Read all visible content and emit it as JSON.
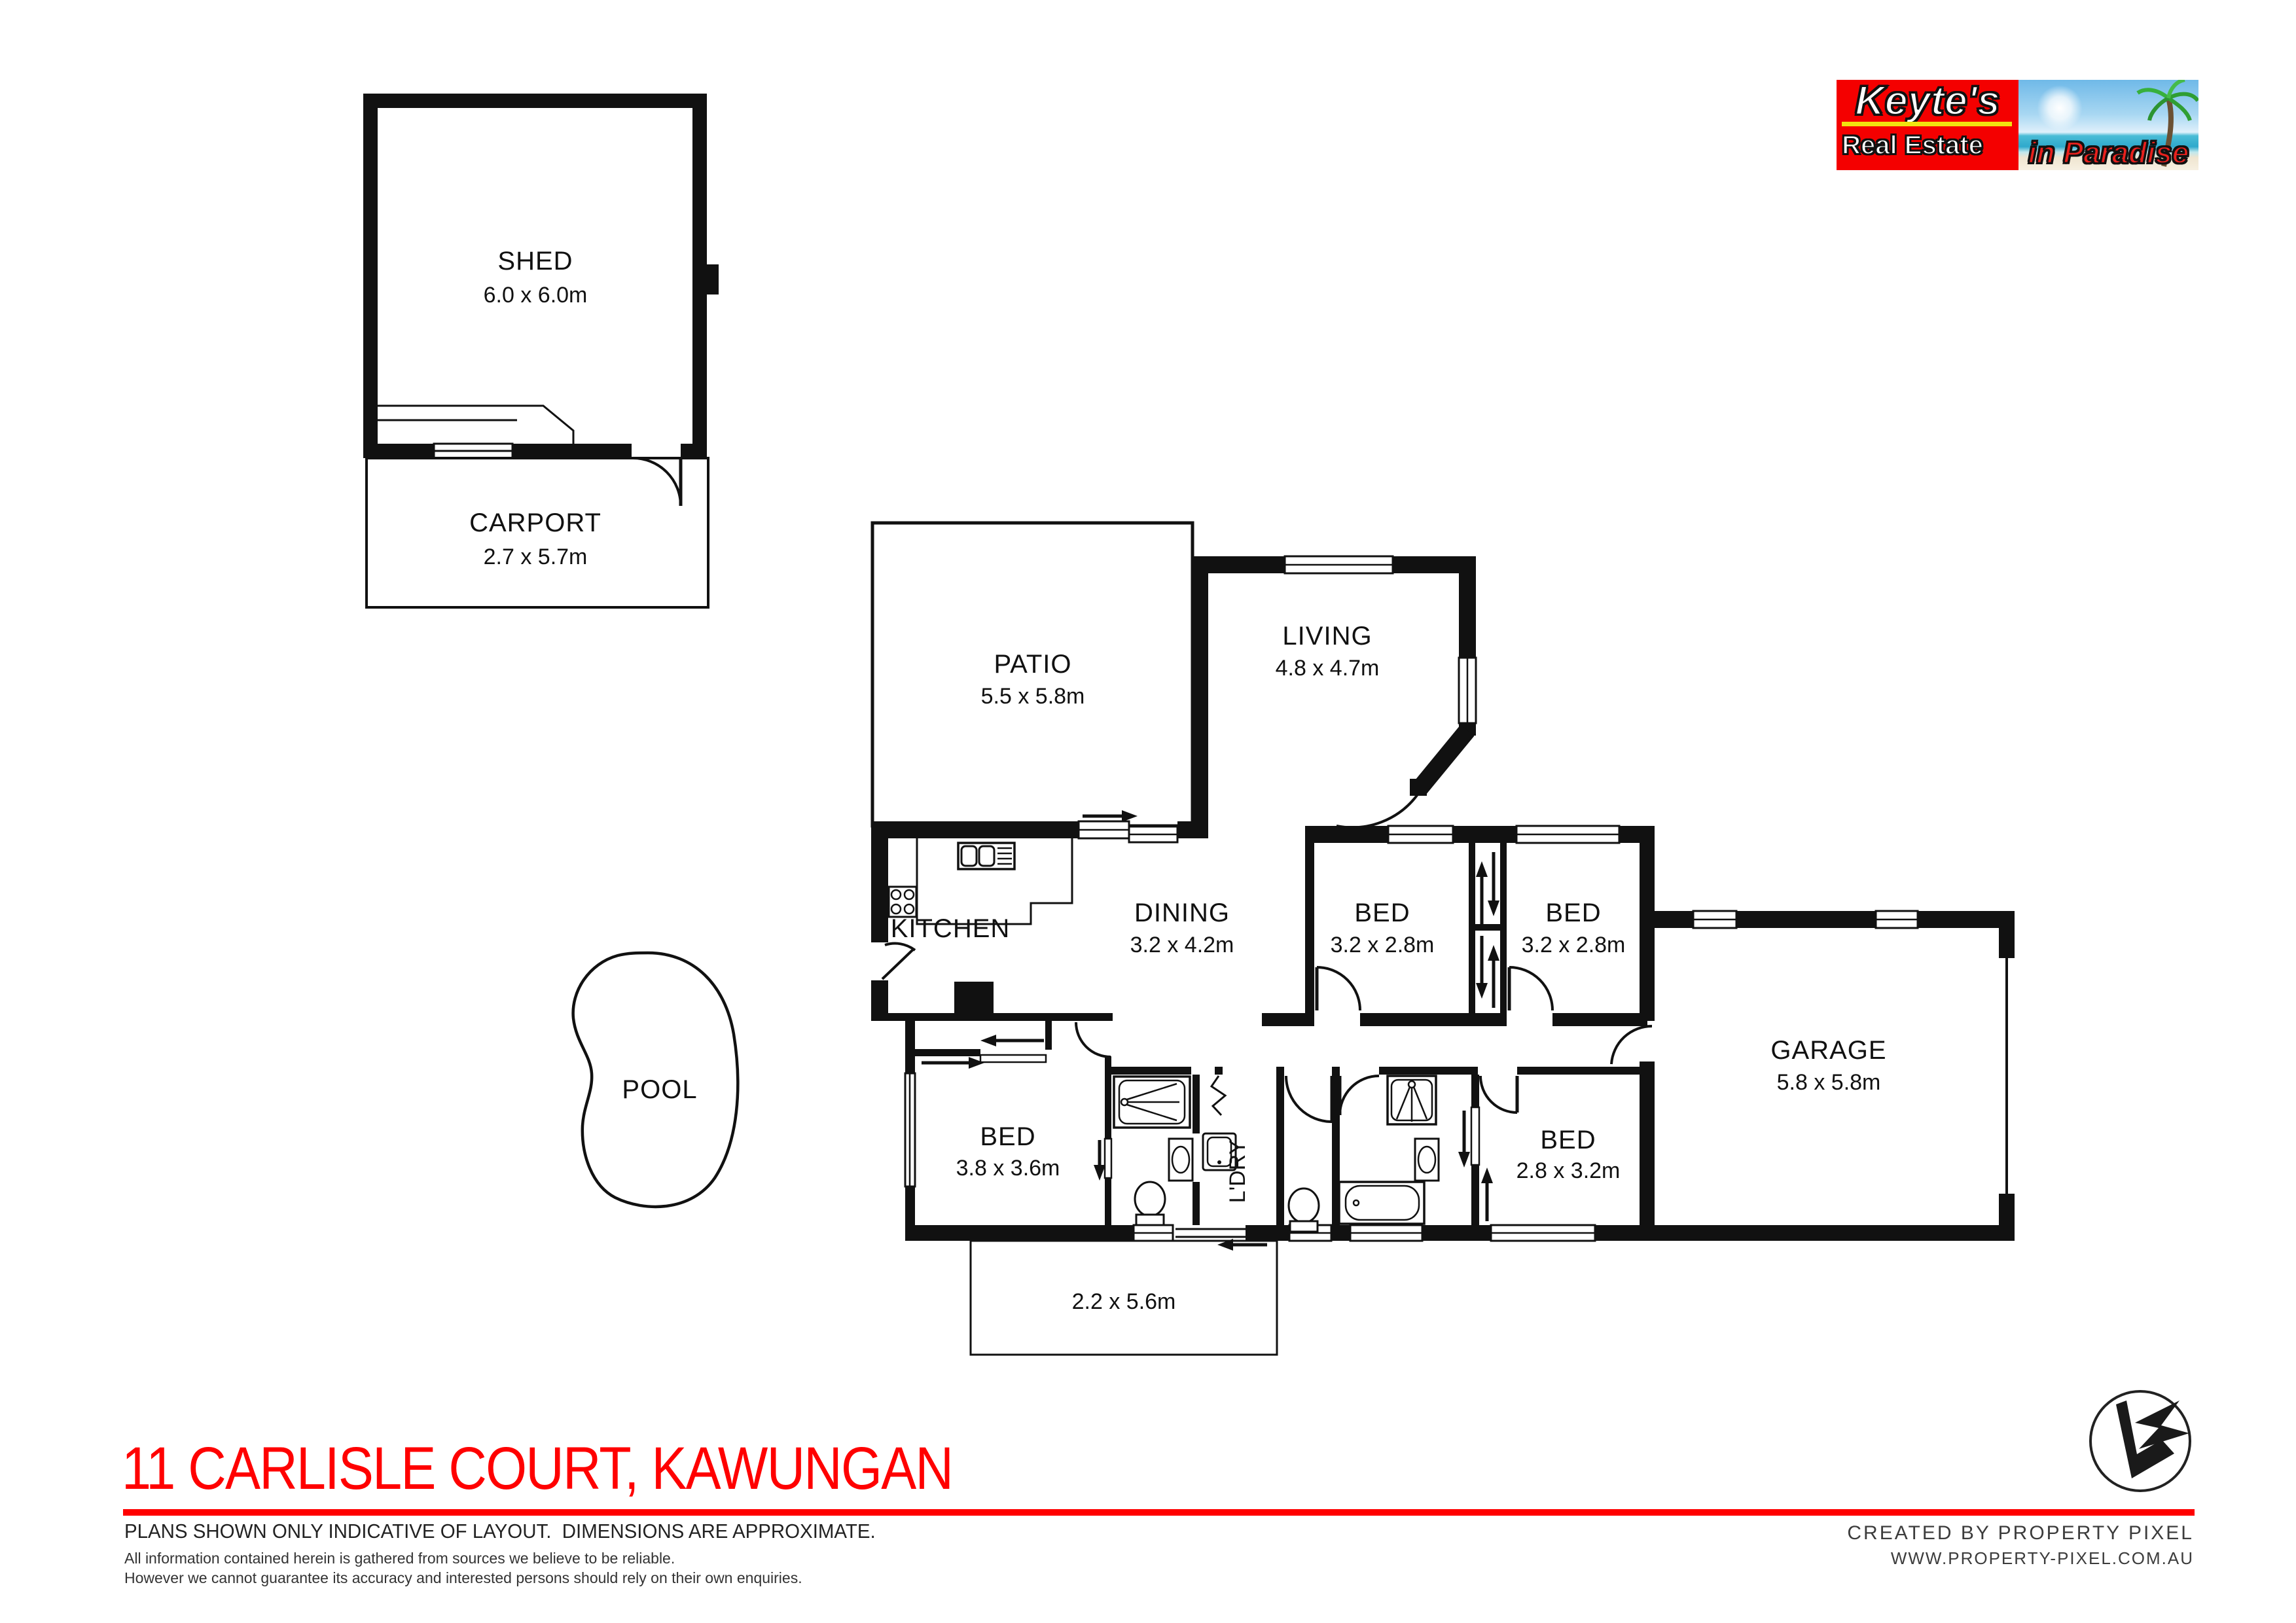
{
  "brand": {
    "name": "Keyte's",
    "subtitle": "Real Estate",
    "tagline": "in Paradise",
    "box_color": "#f40000",
    "underline_color": "#f2e30e",
    "tagline_color": "#e8211d"
  },
  "title": "11 CARLISLE COURT, KAWUNGAN",
  "accent_color": "#ff0000",
  "disclaimer": {
    "main": "PLANS SHOWN ONLY INDICATIVE OF LAYOUT.  DIMENSIONS ARE APPROXIMATE.",
    "note1": "All information contained herein is gathered from sources we believe to be reliable.",
    "note2": "However we cannot guarantee its accuracy and interested persons should rely on their own enquiries."
  },
  "credits": {
    "created_by": "CREATED BY PROPERTY PIXEL",
    "website": "WWW.PROPERTY-PIXEL.COM.AU"
  },
  "rooms": {
    "shed": {
      "name": "SHED",
      "dims": "6.0 x 6.0m"
    },
    "carport": {
      "name": "CARPORT",
      "dims": "2.7 x 5.7m"
    },
    "patio": {
      "name": "PATIO",
      "dims": "5.5 x 5.8m"
    },
    "living": {
      "name": "LIVING",
      "dims": "4.8 x 4.7m"
    },
    "kitchen": {
      "name": "KITCHEN"
    },
    "dining": {
      "name": "DINING",
      "dims": "3.2 x 4.2m"
    },
    "bed1": {
      "name": "BED",
      "dims": "3.2 x 2.8m"
    },
    "bed2": {
      "name": "BED",
      "dims": "3.2 x 2.8m"
    },
    "bed3": {
      "name": "BED",
      "dims": "3.8 x 3.6m"
    },
    "bed4": {
      "name": "BED",
      "dims": "2.8 x 3.2m"
    },
    "garage": {
      "name": "GARAGE",
      "dims": "5.8 x 5.8m"
    },
    "laundry": {
      "name": "L'DRY"
    },
    "pool": {
      "name": "POOL"
    },
    "porch": {
      "dims": "2.2 x 5.6m"
    }
  }
}
